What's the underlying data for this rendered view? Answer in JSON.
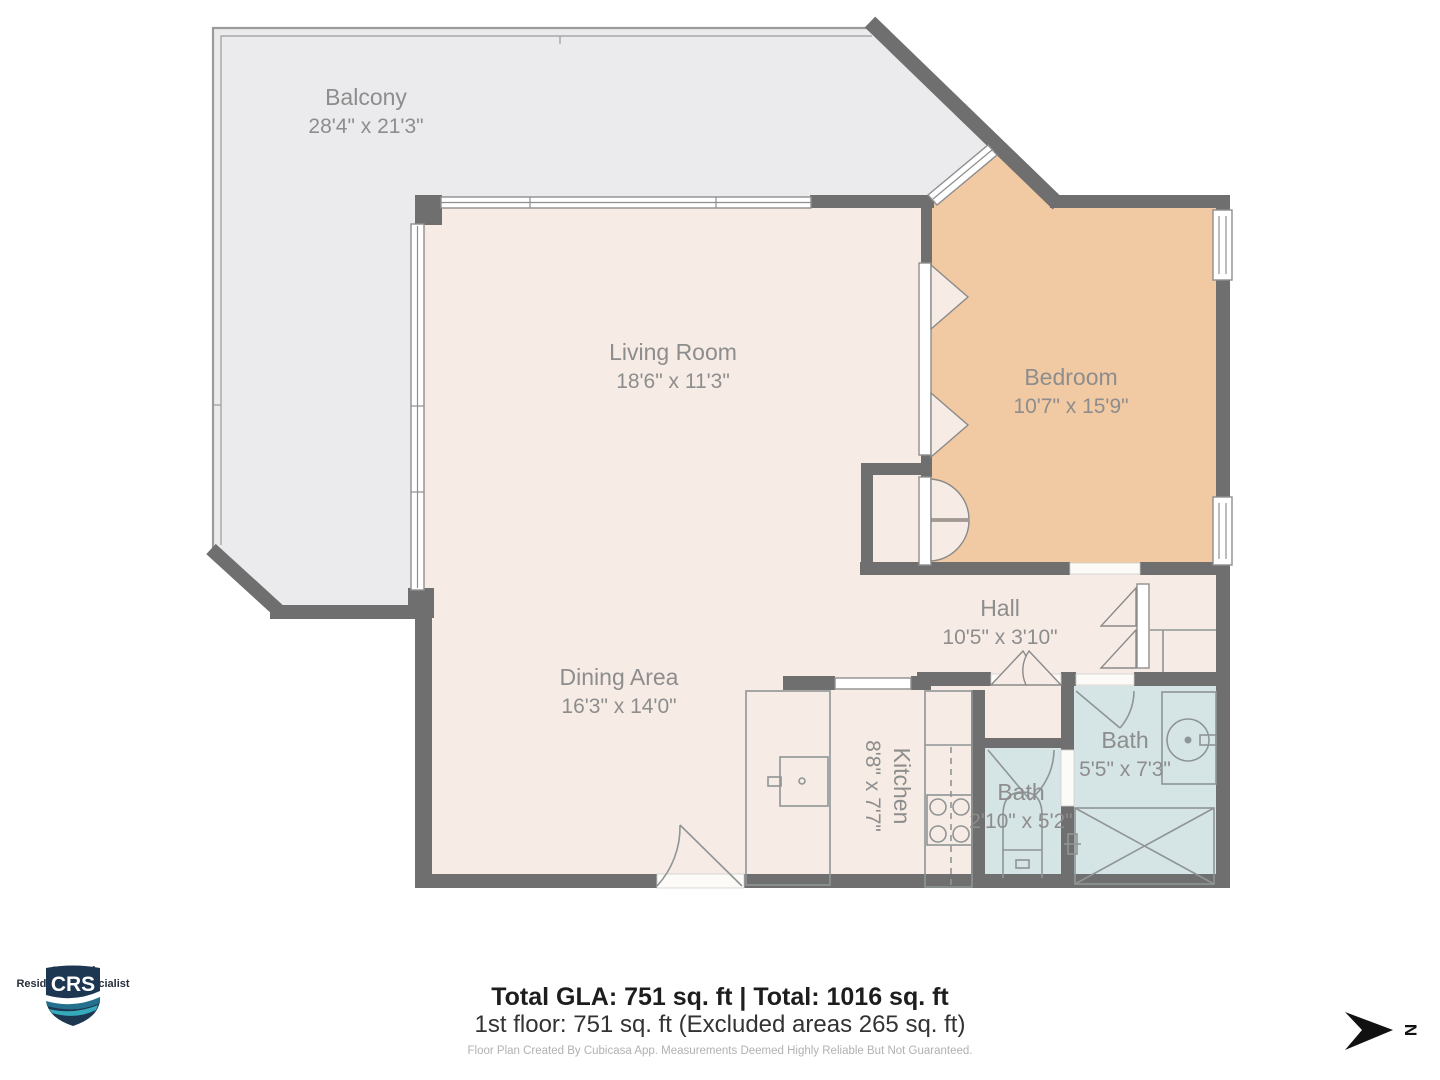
{
  "plan": {
    "colors": {
      "wall": "#6f6f6f",
      "floor": "#f6ece5",
      "balcony": "#ebebed",
      "bedroom": "#f1c9a3",
      "bath": "#d5e4e5",
      "label": "#8d8d8d"
    },
    "rooms": [
      {
        "id": "balcony",
        "name": "Balcony",
        "dims": "28'4\" x 21'3\"",
        "cx": 366,
        "cy": 105,
        "rotated": false
      },
      {
        "id": "living-room",
        "name": "Living Room",
        "dims": "18'6\" x 11'3\"",
        "cx": 673,
        "cy": 360,
        "rotated": false
      },
      {
        "id": "bedroom",
        "name": "Bedroom",
        "dims": "10'7\" x 15'9\"",
        "cx": 1071,
        "cy": 385,
        "rotated": false
      },
      {
        "id": "hall",
        "name": "Hall",
        "dims": "10'5\" x 3'10\"",
        "cx": 1000,
        "cy": 616,
        "rotated": false
      },
      {
        "id": "dining-area",
        "name": "Dining Area",
        "dims": "16'3\" x 14'0\"",
        "cx": 619,
        "cy": 685,
        "rotated": false
      },
      {
        "id": "kitchen",
        "name": "Kitchen",
        "dims": "8'8\" x 7'7\"",
        "cx": 894,
        "cy": 786,
        "rotated": true
      },
      {
        "id": "bath-large",
        "name": "Bath",
        "dims": "5'5\" x 7'3\"",
        "cx": 1125,
        "cy": 748,
        "rotated": false
      },
      {
        "id": "bath-small",
        "name": "Bath",
        "dims": "2'10\" x 5'2\"",
        "cx": 1021,
        "cy": 800,
        "rotated": false
      }
    ]
  },
  "footer": {
    "totals_bold": "Total GLA: 751 sq. ft | Total: 1016 sq. ft",
    "floor_line": "1st floor: 751 sq. ft (Excluded areas 265 sq. ft)",
    "disclaimer": "Floor Plan Created By Cubicasa App. Measurements Deemed Highly Reliable But Not Guaranteed."
  },
  "logo": {
    "acronym": "CRS",
    "line1": "Certified",
    "line2": "Residential Specialist",
    "navy": "#1d3752",
    "teal": "#2f9fb3"
  },
  "compass": {
    "label": "N"
  }
}
